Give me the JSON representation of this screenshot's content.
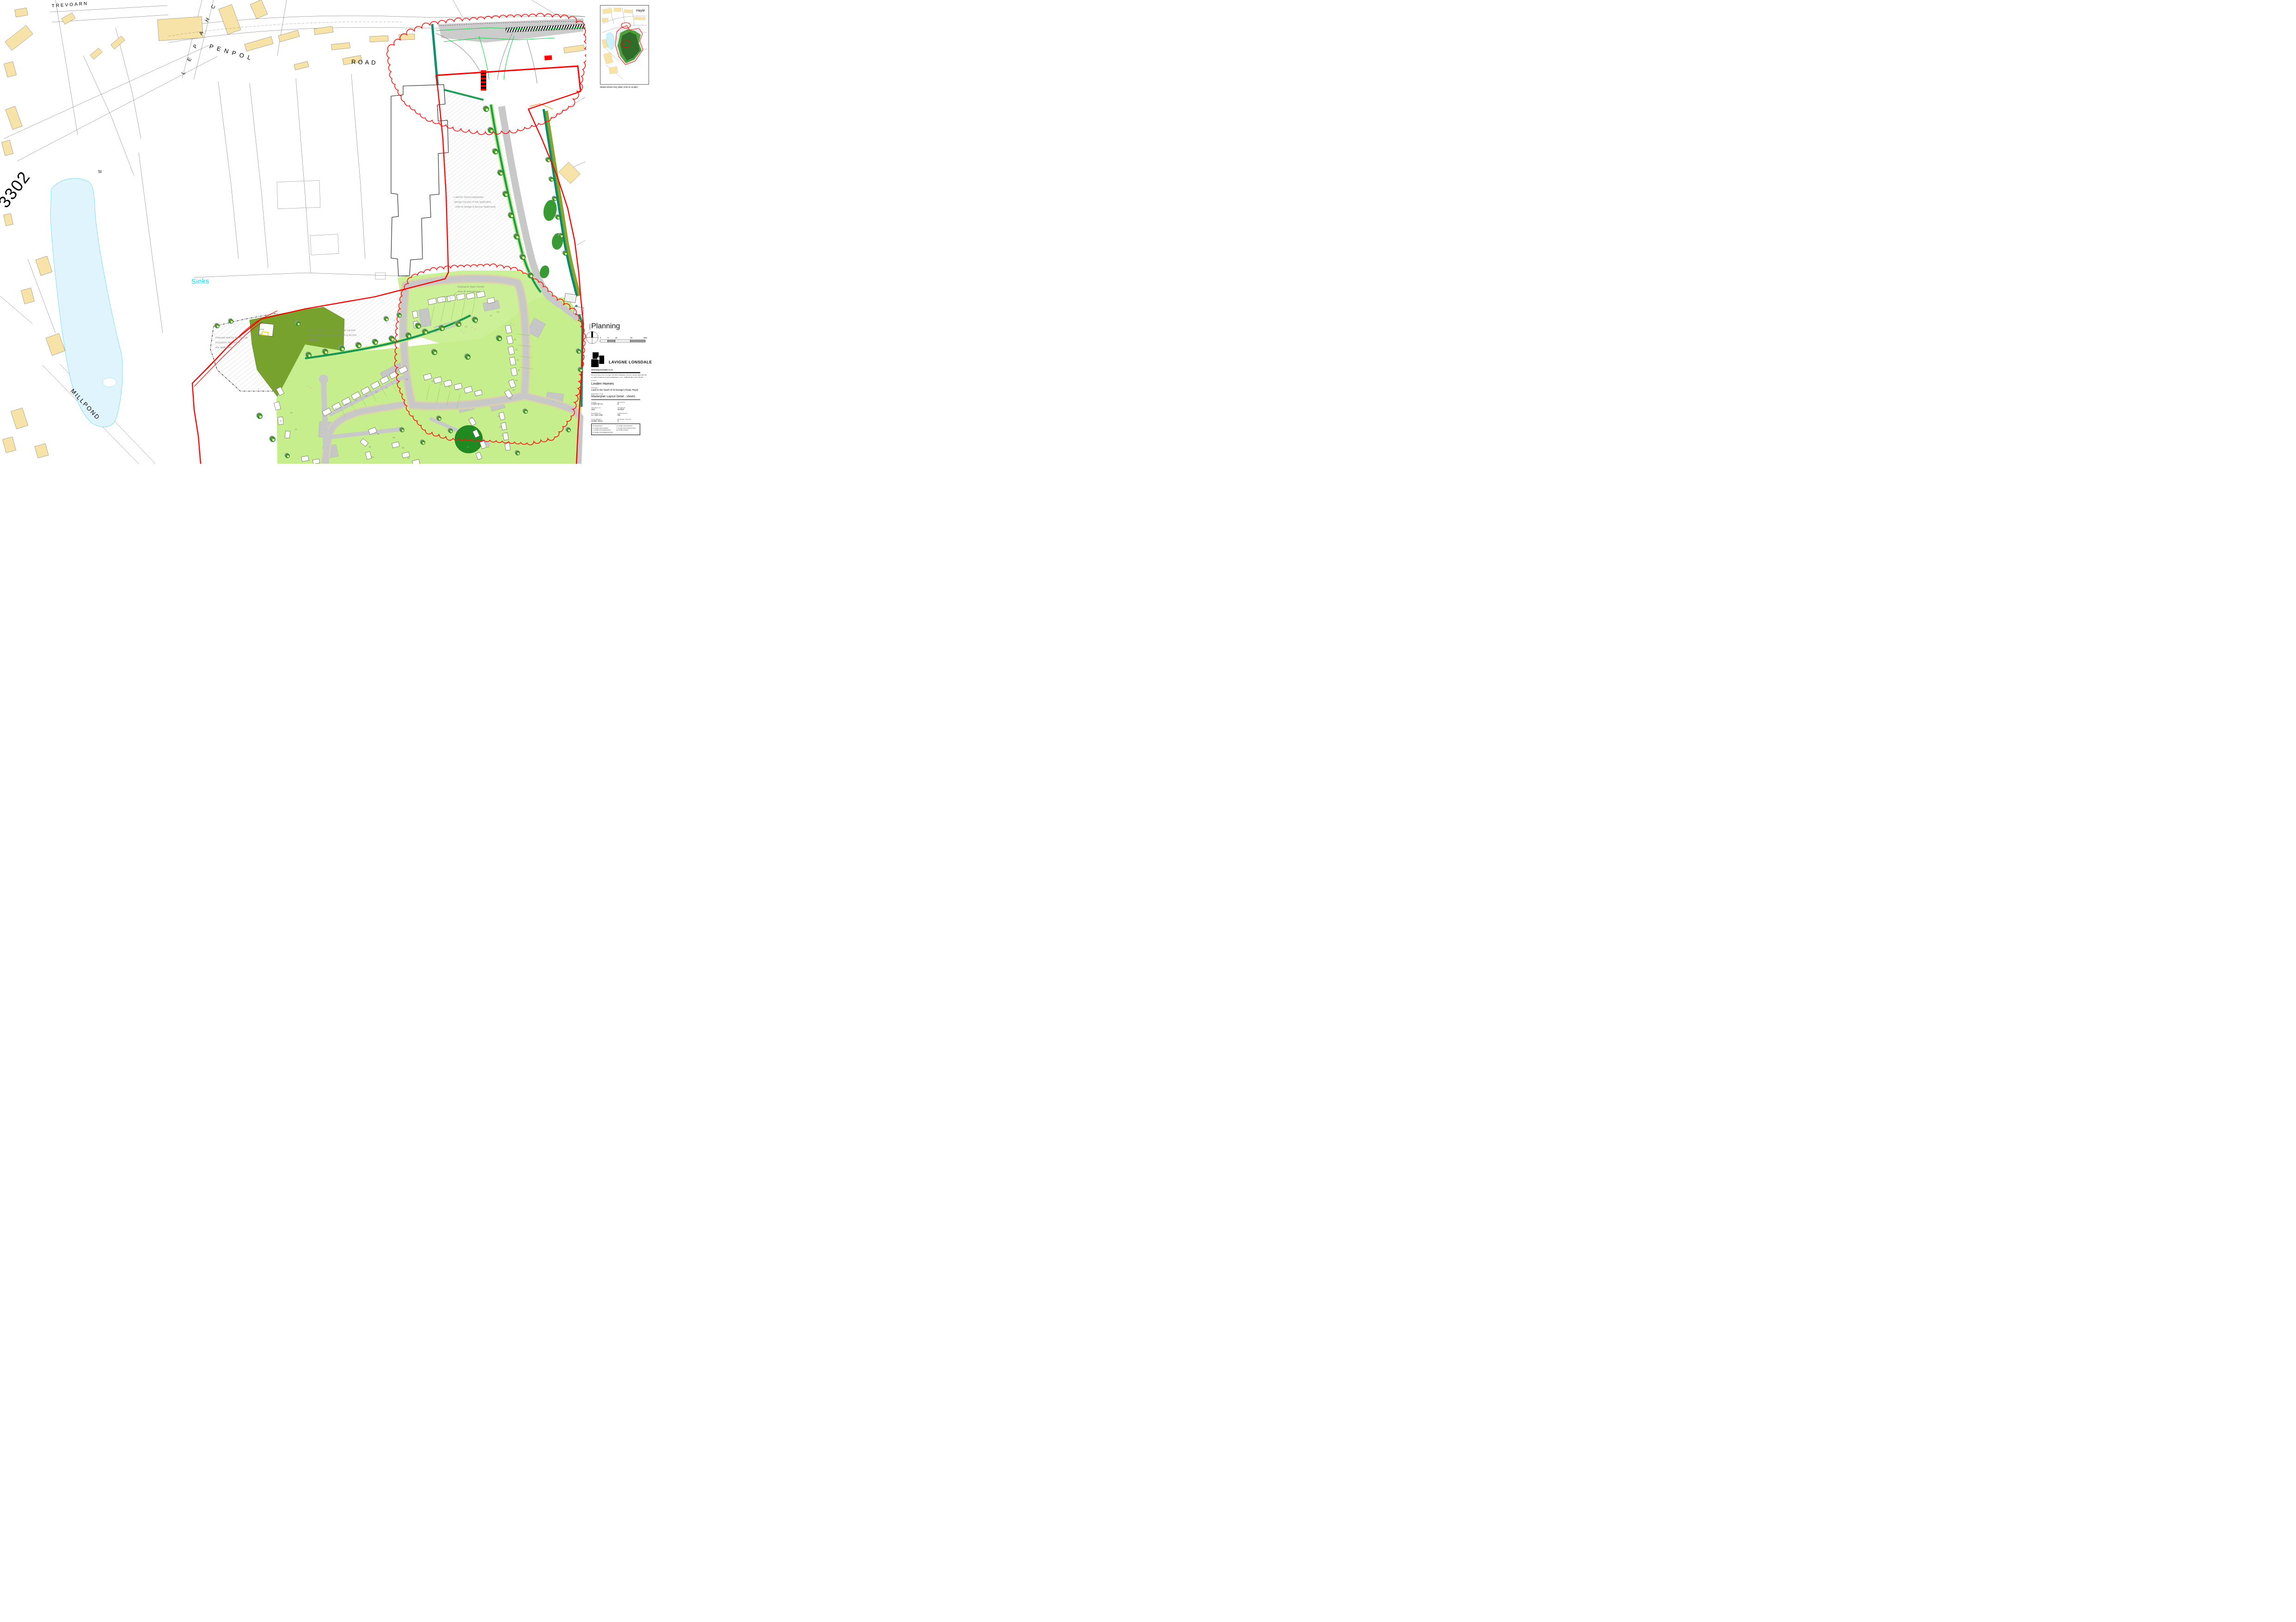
{
  "key_plan": {
    "place": "Hayle",
    "caption": "detail sheet key plan (not to scale)"
  },
  "planning_panel": {
    "title": "Planning",
    "north_label": "NORTH",
    "scale_ticks": [
      "0",
      "5",
      "10",
      "20",
      "30m"
    ]
  },
  "title_block": {
    "company": "LAVIGNE LONSDALE",
    "website": "www.lavignelonsdale.co.uk",
    "address_line1": "55 Lemon Street,  Truro,   Cornwall,   TR1 2PE   &  38 Belgrave Crescent, Camden, Bath, BA1 5JU",
    "address_line2": "tel: 01872 273118 (truro)        01225 421539(bath)      or mob - 07989 396 360 / 07917 783 290",
    "client_label": "CLIENT",
    "client": "Linden Homes",
    "project_label": "PROJECT",
    "project": "Land to the South of St.George's Road, Hayle",
    "drawing_title_label": "DRAWING TITLE",
    "drawing_title": "Masterplan Layout Detail - sheet1",
    "scale_label": "SCALE",
    "scale": "1:500 @ A1",
    "revision_label": "REVISION",
    "revision": "E",
    "project_no_label": "PROJECT No",
    "project_no": "192",
    "drawn_by_label": "DRAWN BY",
    "drawn_by": "KH/NF",
    "drawing_no_label": "DRAWING No",
    "drawing_no": "LL-192-156",
    "checked_by_label": "CHECKED BY",
    "checked_by": "ML",
    "date_label": "DATE DRAWN",
    "date": "JUNE 2014",
    "status_label": "DRAWING STATUS",
    "status": "b",
    "status_legend": [
      {
        "key": "a",
        "label": "PRELIMINARY"
      },
      {
        "key": "b",
        "label": "ISSUED FOR PLANNING"
      },
      {
        "key": "c",
        "label": "ISSUED FOR INFORMATION"
      },
      {
        "key": "d",
        "label": "ISSUED FOR TENDER/COSTING"
      },
      {
        "key": "e",
        "label": "ISSUED FOR APPROVAL"
      },
      {
        "key": "f",
        "label": "ISSUED FOR CONSTRUCTION"
      },
      {
        "key": "g",
        "label": "ISSUED AS BUILT"
      }
    ]
  },
  "map": {
    "street_labels": [
      {
        "id": "trevoarn",
        "text": "TREVOARN"
      },
      {
        "id": "chapel",
        "text": "CHAPEL"
      },
      {
        "id": "penpol",
        "text": "PENPOL"
      },
      {
        "id": "road",
        "text": "ROAD"
      },
      {
        "id": "b3302",
        "text": "3302"
      },
      {
        "id": "millpond",
        "text": "MILLPOND"
      },
      {
        "id": "si",
        "text": "SI"
      },
      {
        "id": "sinks",
        "text": "Sinks"
      }
    ],
    "annotations": [
      {
        "id": "school-expansion-1",
        "lines": [
          "Land for School expansion",
          "(design not part of this application",
          "- refer to Design & Access Statement)"
        ]
      },
      {
        "id": "school-parking",
        "lines": [
          "Parking for future School",
          "drop off arrangement"
        ]
      },
      {
        "id": "school-expansion-2",
        "lines": [
          "Land for School expansion (design not part",
          "of this application - refer to Design & Access",
          "Statement)"
        ]
      },
      {
        "id": "tennis-club",
        "lines": [
          "Potential land for Tennis Club",
          "expansion. Not part of",
          "this application"
        ]
      },
      {
        "id": "pumping-station",
        "lines": [
          "Pumping",
          "Station"
        ]
      }
    ],
    "plot_numbers": [
      "10",
      "11",
      "12",
      "13",
      "14-15",
      "16-19",
      "20",
      "21",
      "22",
      "23",
      "28",
      "29",
      "30",
      "31",
      "32",
      "33",
      "34",
      "35",
      "36",
      "37",
      "38",
      "39",
      "40",
      "41",
      "42",
      "44",
      "45",
      "46",
      "47",
      "48",
      "49",
      "50",
      "76",
      "77",
      "78",
      "79",
      "81",
      "82",
      "83",
      "84",
      "93",
      "94",
      "95"
    ],
    "parking_markers": [
      "V",
      "P",
      "G"
    ],
    "colors": {
      "boundary_red": "#ff0000",
      "cloud_red": "#ff1414",
      "building_tan": "#F7E3A8",
      "pond_fill": "#E0F4FD",
      "pond_edge": "#4ED9EA",
      "cyan_text": "#00E8FF",
      "hedge_green": "#1F9D57",
      "teal_green": "#0F8F6E",
      "olive_green": "#76A22D",
      "garden_green": "#C7EE8C",
      "road_grey": "#C8C8C8",
      "footpath_beige": "#DBD2AC",
      "annotation_grey": "#8A8A8A",
      "tree_green": "#2F8F2B"
    }
  }
}
